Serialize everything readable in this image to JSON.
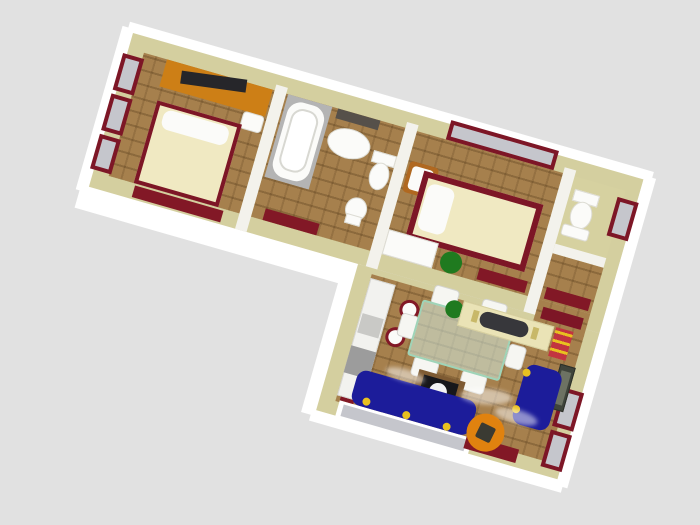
{
  "scene": {
    "label": "3D aerial rendering of an apartment floor plan",
    "background": "#e1e1e1"
  },
  "rooms": {
    "bedroom1": {
      "label": "bedroom-1"
    },
    "bathroom": {
      "label": "bathroom"
    },
    "bedroom2": {
      "label": "bedroom-2"
    },
    "wc": {
      "label": "wc"
    },
    "hall": {
      "label": "hall"
    },
    "living": {
      "label": "living-dining-room"
    },
    "kitchen": {
      "label": "kitchen-corner"
    }
  },
  "furniture": {
    "dresser": {
      "label": "orange dresser with tv"
    },
    "bed1": {
      "label": "double bed"
    },
    "bed2": {
      "label": "bed with maroon frame"
    },
    "bathtub": {
      "label": "bathtub in enclosure"
    },
    "sink": {
      "label": "washbasin"
    },
    "mirror": {
      "label": "mirror shelf"
    },
    "toilet_bath": {
      "label": "toilet"
    },
    "bidet": {
      "label": "bidet"
    },
    "toilet_wc": {
      "label": "toilet"
    },
    "chair_bd2": {
      "label": "wooden chair"
    },
    "desk_bd2": {
      "label": "white desk"
    },
    "plant_bd2": {
      "label": "potted plant"
    },
    "counter": {
      "label": "kitchen counter"
    },
    "stove": {
      "label": "stove"
    },
    "stools": {
      "label": "bar stools"
    },
    "mat": {
      "label": "dark slatted mat"
    },
    "dining_table": {
      "label": "glass dining table"
    },
    "dining_chairs": {
      "label": "white dining chairs"
    },
    "sideboard": {
      "label": "sideboard with stereo"
    },
    "plant_lv": {
      "label": "potted plant"
    },
    "red_cabinet": {
      "label": "red cabinet with yellow shelves"
    },
    "console": {
      "label": "dark console"
    },
    "coffee_table": {
      "label": "coffee table with sphere lamp"
    },
    "sofa_big": {
      "label": "large blue sofa"
    },
    "sofa_love": {
      "label": "blue loveseat"
    },
    "orange_chair": {
      "label": "round orange chair"
    },
    "entrance_door": {
      "label": "entrance door"
    },
    "windows": {
      "label": "window with maroon frame"
    },
    "radiators": {
      "label": "maroon radiator"
    }
  },
  "colors": {
    "background": "#e1e1e1",
    "wall_top": "#d4cf9f",
    "wall_face": "#ffffff",
    "interior_wall": "#f3f2ec",
    "floor_wood": "#a6804d",
    "floor_khaki": "#d6d1a0",
    "maroon": "#7d1626",
    "radiator": "#821826",
    "glass": "#c5c6cc",
    "dresser_orange": "#cd7f16",
    "tv_dark": "#26262a",
    "bed_cream": "#f0e9c2",
    "fixture_white": "#fbfbf9",
    "enclosure_gray": "#b4b4b4",
    "mirror_dark": "#56504a",
    "chair_frame": "#b06820",
    "plant_green": "#1f7a1f",
    "counter_white": "#f2f2ef",
    "stove_gray": "#9c9c9c",
    "sink_gray": "#c9c9c6",
    "stool_maroon": "#821826",
    "table_glass_edge": "#9fd4b8",
    "table_glass_fill": "rgba(212,236,226,0.55)",
    "sideboard_cream": "#eae3b6",
    "stereo_dark": "#37373b",
    "console_dark": "#3f443b",
    "console_inner": "#6d7263",
    "coffee_brown": "#7d5a32",
    "coffee_top": "#17171a",
    "sofa_blue": "#1c1c9a",
    "accent_yellow": "#e8c020",
    "chair_orange": "#e0820f",
    "red_cabinet": "#c23440"
  }
}
